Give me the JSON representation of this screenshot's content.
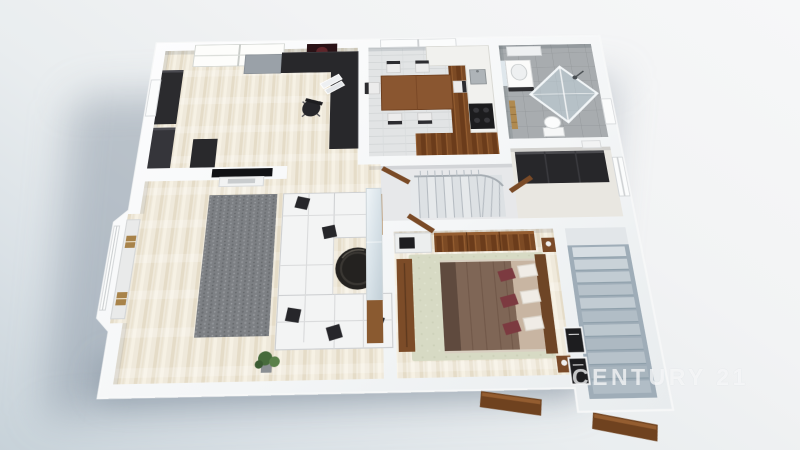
{
  "watermark": {
    "text": "CENTURY 21",
    "color": "rgba(255,255,255,0.65)"
  },
  "scene": {
    "type": "3d-floor-plan-render",
    "view": "tilted-top-down-perspective",
    "rooms": [
      {
        "name": "office",
        "furniture": [
          "l-shaped-desk",
          "office-chair",
          "laptop",
          "sideboard",
          "bookcases",
          "roof-window",
          "wall-picture",
          "window"
        ]
      },
      {
        "name": "kitchen-dining",
        "furniture": [
          "dining-table",
          "six-chairs",
          "l-shaped-counter",
          "sink",
          "stove",
          "window",
          "wood-floor-strip"
        ]
      },
      {
        "name": "bathroom",
        "furniture": [
          "vanity-sink",
          "mirror",
          "wall-shelf",
          "corner-glass-shower",
          "toilet",
          "towel-ladder",
          "window"
        ]
      },
      {
        "name": "hallway",
        "furniture": [
          "winder-staircase",
          "railing",
          "open-doors"
        ]
      },
      {
        "name": "dressing-room",
        "furniture": [
          "dark-wardrobes",
          "window",
          "open-door"
        ]
      },
      {
        "name": "living-room",
        "furniture": [
          "sectional-sofa",
          "throw-pillows",
          "round-coffee-table",
          "speckled-rug",
          "tv-wall",
          "media-shelf",
          "mirrored-wardrobe",
          "wood-cabinet",
          "plant",
          "bay-window-seat"
        ]
      },
      {
        "name": "bedroom",
        "furniture": [
          "double-bed",
          "headboard",
          "white-pillows",
          "maroon-pillows",
          "nightstands",
          "wardrobe",
          "dresser",
          "corner-unit-tv",
          "sage-rug",
          "open-door"
        ]
      },
      {
        "name": "entrance-stairwell",
        "furniture": [
          "exterior-staircase",
          "landing",
          "electrical-panels",
          "open-entry-doors"
        ]
      }
    ],
    "colors": {
      "background_light": "#f6f7f8",
      "background_shadowed": "#c7d2d9",
      "walls": "#f8f9fa",
      "floor_cream": "#efe9db",
      "floor_tile_gray": "#a8acaf",
      "floor_plank_gray": "#e3e5e6",
      "wood": "#7c4a24",
      "dark_furniture": "#28282b",
      "sofa_white": "#f3f4f4",
      "rug_gray": "#7d8084",
      "rug_sage": "#d7dac4",
      "bed_maroon": "#7c3a40",
      "stairs_blue_gray": "#b1bdc6"
    }
  }
}
